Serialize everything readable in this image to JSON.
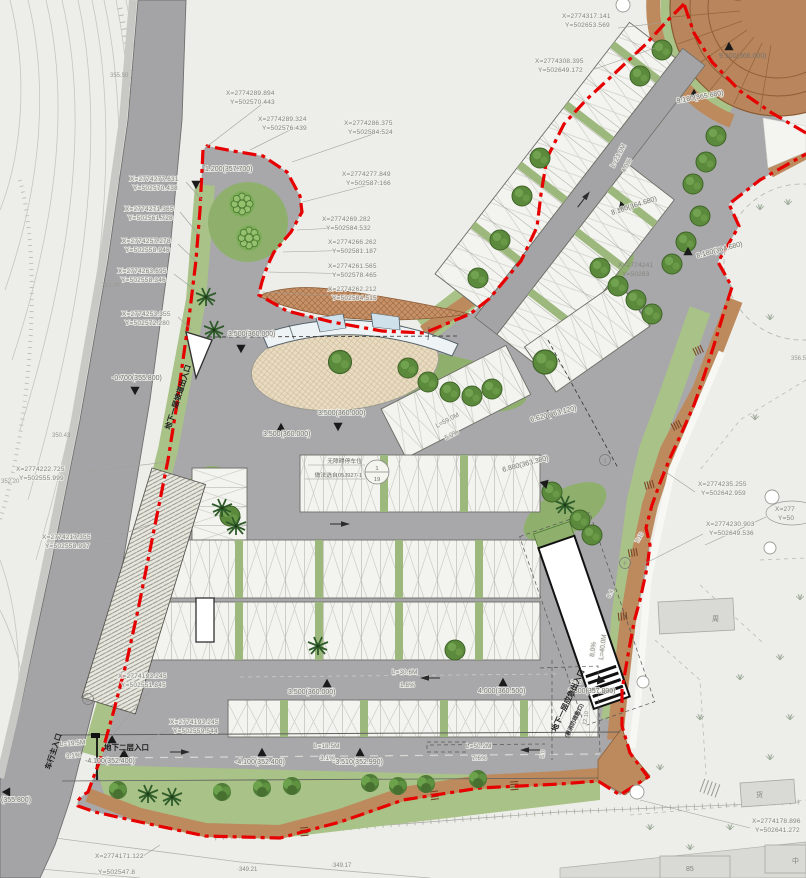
{
  "drawing": {
    "type": "landscape parking site plan",
    "boundary_color": "#e60000",
    "asphalt": "#a7a7a9",
    "green": "#a9c287",
    "slope_brown": "#bd8a5e",
    "deck_wood": "#b9855c"
  },
  "coords": [
    {
      "x": "X=2774289.894",
      "y": "Y=502570.443"
    },
    {
      "x": "X=2774289.324",
      "y": "Y=502576.439"
    },
    {
      "x": "X=2774286.375",
      "y": "Y=502584.524"
    },
    {
      "x": "X=2774277.849",
      "y": "Y=502587.166"
    },
    {
      "x": "X=2774269.282",
      "y": "Y=502584.532"
    },
    {
      "x": "X=2774266.262",
      "y": "Y=502581.187"
    },
    {
      "x": "X=2774261.565",
      "y": "Y=502578.465"
    },
    {
      "x": "X=2774262.212",
      "y": "Y=502584.515"
    },
    {
      "x": "X=2774277.631",
      "y": "Y=502570.438"
    },
    {
      "x": "X=2774271.365",
      "y": "Y=502561.728"
    },
    {
      "x": "X=2774257.278",
      "y": "Y=502558.946"
    },
    {
      "x": "X=2774263.695",
      "y": "Y=502558.346"
    },
    {
      "x": "X=2774253.355",
      "y": "Y=502572.280"
    },
    {
      "x": "X=2774222.725",
      "y": "Y=502555.999"
    },
    {
      "x": "X=2774217.355",
      "y": "Y=502558.997"
    },
    {
      "x": "X=2774193.245",
      "y": "Y=502551.845"
    },
    {
      "x": "X=2774193.245",
      "y": "Y=502559.544"
    },
    {
      "x": "X=2774171.122",
      "y": "Y=502547.8"
    },
    {
      "x": "X=2774317.141",
      "y": "Y=502653.569"
    },
    {
      "x": "X=2774308.395",
      "y": "Y=502649.172"
    },
    {
      "x": "X=2774241",
      "y": "Y=50263"
    },
    {
      "x": "X=2774235.255",
      "y": "Y=502642.959"
    },
    {
      "x": "X=2774230.903",
      "y": "Y=502649.536"
    },
    {
      "x": "X=2774178.896",
      "y": "Y=502641.272"
    },
    {
      "x": "X=277",
      "y": "Y=50"
    }
  ],
  "elev": [
    "1.200(357.700)",
    "-0.700(355.800)",
    "(355.800)",
    "3.500(360.000)",
    "3.500(360.000)",
    "3.500(360.000)",
    "6.620(363.120)",
    "6.880(363.380)",
    "8.180(364.680)",
    "8.180(364.680)",
    "9.500(366.000)",
    "9.180(365.680)",
    "3.500(360.000)",
    "4.000(360.500)",
    "-4.100(352.400)",
    "-4.100(352.400)",
    "-3.510(352.990)",
    "1.300(357.800)"
  ],
  "grades": [
    {
      "len": "L=19.5M",
      "slope": "3.1%"
    },
    {
      "len": "L=18.5M",
      "slope": "3.1%"
    },
    {
      "len": "L=50.2M",
      "slope": "7.6%"
    },
    {
      "len": "L=30.6M",
      "slope": "1.8%"
    },
    {
      "len": "L=59.0M",
      "slope": "5.0%"
    },
    {
      "len": "L=23.0M",
      "slope": "4.0%"
    },
    {
      "len": "L=40.0M",
      "slope": "8.0%"
    }
  ],
  "dims": [
    "2.00",
    "12.10",
    "5.0",
    "8.4",
    "7.10"
  ],
  "entrances": [
    "车行主入口",
    "地下二层入口",
    "地下一层坡道出入口",
    "地下一层应急出入口",
    "(兼消防疏散口)"
  ],
  "bubble": {
    "line1": "无障碍停车位",
    "line2": "做法选自05J927-1",
    "num": "1",
    "den": "19"
  },
  "spots": [
    "·349.21",
    "·349.17"
  ],
  "contours": [
    "355.50",
    "351.90",
    "350.43",
    "352.20",
    "356.5"
  ],
  "marks": [
    "1",
    "B",
    "F"
  ],
  "ext": [
    "周",
    "货",
    "85",
    "中"
  ]
}
